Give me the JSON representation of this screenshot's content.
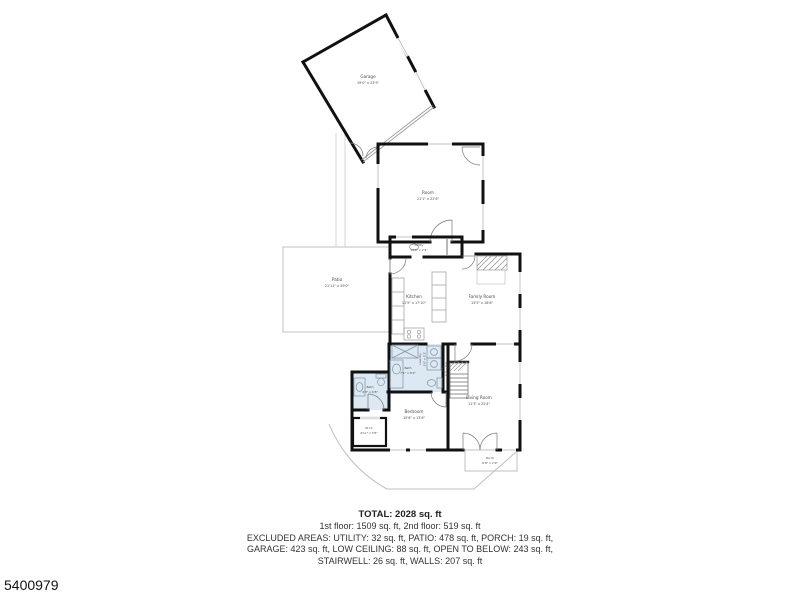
{
  "rooms": {
    "garage": {
      "name": "Garage",
      "dims": "19'0\" x 23'9\""
    },
    "room": {
      "name": "Room",
      "dims": "21'1\" x 22'6\""
    },
    "utility": {
      "name": "Utility",
      "dims": "13'8\" x 2'4\""
    },
    "patio": {
      "name": "Patio",
      "dims": "21'11\" x 39'0\""
    },
    "kitchen": {
      "name": "Kitchen",
      "dims": "11'5\" x 17'10\""
    },
    "family_room": {
      "name": "Family Room",
      "dims": "13'5\" x 18'6\""
    },
    "bath_main": {
      "name": "Bath",
      "dims": "7'1\" x 8'2\""
    },
    "laundry": {
      "name": "Laundry",
      "dims": "3'6\" x 5'1\""
    },
    "hall": {
      "name": "Hall",
      "dims": "3'2\" x 8'6\""
    },
    "bath_small": {
      "name": "Bath",
      "dims": "4'3\" x 6'8\""
    },
    "bedroom": {
      "name": "Bedroom",
      "dims": "10'6\" x 13'6\""
    },
    "living_room": {
      "name": "Living Room",
      "dims": "11'3\" x 22'4\""
    },
    "wic": {
      "name": "W.I.C",
      "dims": "4'11\" x 3'5\""
    },
    "porch": {
      "name": "Porch",
      "dims": "6'8\" x 2'9\""
    }
  },
  "summary": {
    "total": "TOTAL: 2028 sq. ft",
    "floors": "1st floor: 1509 sq. ft, 2nd floor: 519 sq. ft",
    "excluded_1": "EXCLUDED AREAS: UTILITY: 32 sq. ft, PATIO: 478 sq. ft, PORCH: 19 sq. ft,",
    "excluded_2": "GARAGE: 423 sq. ft, LOW CEILING: 88 sq. ft, OPEN TO BELOW: 243 sq. ft,",
    "excluded_3": "STAIRWELL: 26 sq. ft, WALLS: 207 sq. ft"
  },
  "photo_number": "5400979",
  "colors": {
    "wall": "#111111",
    "bath_fill": "#dce8f2",
    "thin_outline": "#b5b5b5",
    "label_text": "#4a4a4a"
  }
}
